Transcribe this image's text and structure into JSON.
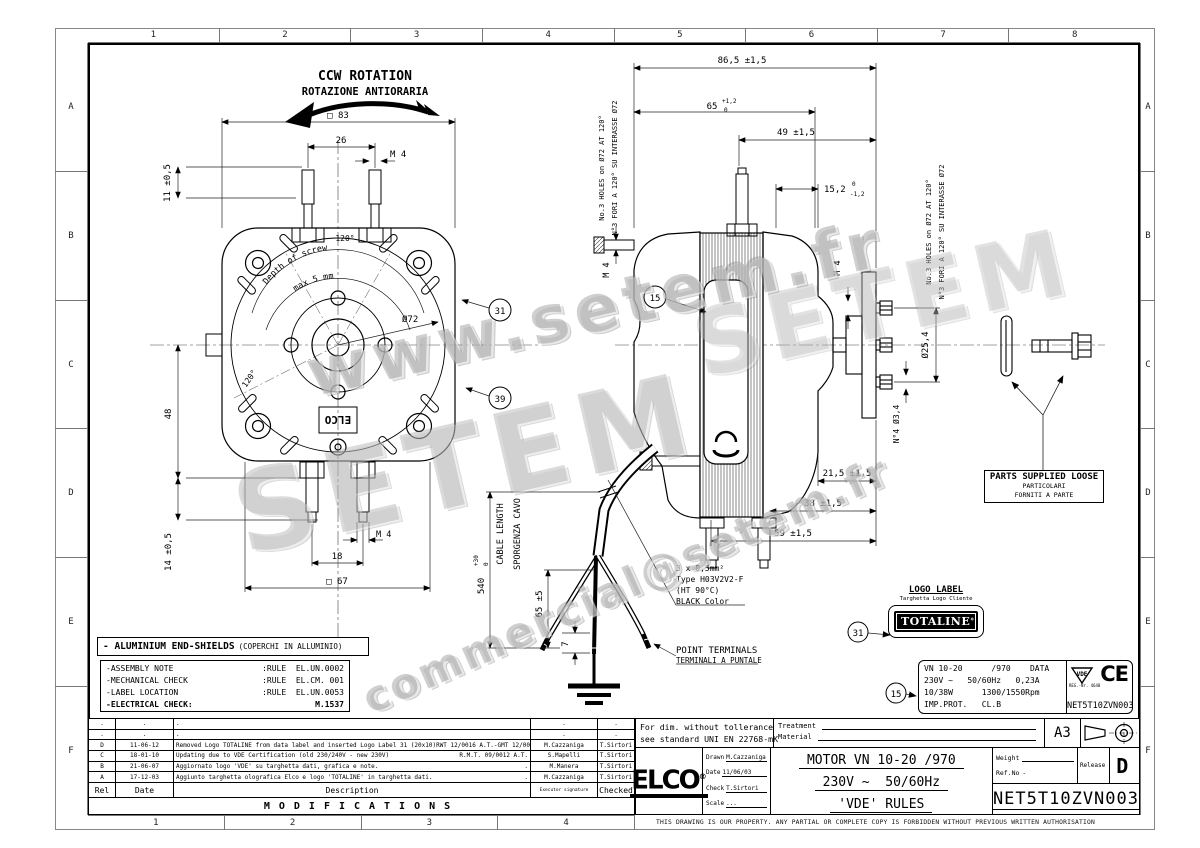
{
  "border": {
    "top": [
      "1",
      "2",
      "3",
      "4",
      "5",
      "6",
      "7",
      "8"
    ],
    "bottom": [
      "1",
      "2",
      "3",
      "4"
    ],
    "left": [
      "A",
      "B",
      "C",
      "D",
      "E",
      "F"
    ],
    "right": [
      "A",
      "B",
      "C",
      "D",
      "E",
      "F"
    ]
  },
  "watermarks": {
    "w1": "www.setem.fr",
    "w2": "SETEM",
    "w3": "commercial@setem.fr"
  },
  "rotation": {
    "en": "CCW ROTATION",
    "it": "ROTAZIONE ANTIORARIA"
  },
  "front": {
    "sq83": "□ 83",
    "d26": "26",
    "m4_top": "M 4",
    "d11": "11 ±0,5",
    "deg120_top": "120°",
    "deg120_left": "120°",
    "dia72": "Ø72",
    "depth_line1": "Depth of screw",
    "depth_line2": "max 5 mm",
    "d48": "48",
    "d14": "14 ±0,5",
    "d18": "18",
    "m4_bottom": "M 4",
    "sq67": "□ 67",
    "elco_emboss": "ELCO"
  },
  "side": {
    "d86": "86,5 ±1,5",
    "d65": "65",
    "d65_tol_top": "+1,2",
    "d65_tol_bot": "0",
    "d49": "49 ±1,5",
    "d152": "15,2",
    "d152_tol_top": "0",
    "d152_tol_bot": "-1,2",
    "m4_left": "M 4",
    "m4_right": "M 4",
    "dia254": "Ø25,4",
    "n4dia": "N°4 Ø3,4",
    "d215": "21,5 ±1,5",
    "d38": "38 ±1,5",
    "d59": "59 ±1,5",
    "holes_en": "No.3 HOLES on Ø72 AT 120°",
    "holes_it": "N°3 FORI A 120° SU INTERASSE Ø72"
  },
  "cable": {
    "len_en": "CABLE LENGTH",
    "len_it": "SPORGENZA CAVO",
    "d540": "540",
    "d540_tol_top": "+30",
    "d540_tol_bot": "0",
    "d65": "65 ±5",
    "d7": "7",
    "spec1": "3 x 0,5mm²",
    "spec2": "Type H03V2V2-F",
    "spec3": "(HT 90°C)",
    "spec4": "BLACK Color",
    "term_en": "POINT TERMINALS",
    "term_it": "TERMINALI A PUNTALE"
  },
  "callouts": {
    "c15": "15",
    "c31": "31",
    "c39": "39"
  },
  "parts_loose": {
    "en": "PARTS SUPPLIED LOOSE",
    "it1": "PARTICOLARI",
    "it2": "FORNITI A PARTE"
  },
  "logo_label": {
    "title": "LOGO LABEL",
    "subtitle": "Targhetta Logo Cliente",
    "brand": "TOTALINE"
  },
  "data_label": {
    "l1": "VN 10-20      /970    DATA",
    "l2": "230V ~   50/60Hz   0,23A",
    "l3": "10/38W      1300/1550Rpm",
    "l4": "IMP.PROT.   CL.B",
    "vde": "VDE",
    "reg": "REG.-Nr. 4648",
    "ce": "CE",
    "code": "NET5T10ZVN003"
  },
  "notes": {
    "title": "- ALUMINIUM END-SHIELDS",
    "title_it": "(COPERCHI IN ALLUMINIO)",
    "rows": [
      {
        "label": "-ASSEMBLY NOTE",
        "value": ":RULE  EL.UN.0002"
      },
      {
        "label": "-MECHANICAL CHECK",
        "value": ":RULE  EL.CM. 001"
      },
      {
        "label": "-LABEL LOCATION",
        "value": ":RULE  EL.UN.0053"
      },
      {
        "label": "-ELECTRICAL CHECK:",
        "value": "M.1537"
      }
    ]
  },
  "modifications": {
    "title": "MODIFICATIONS",
    "headers": {
      "rel": "Rel",
      "date": "Date",
      "desc": "Description",
      "exec": "Executor signature",
      "checked": "Checked"
    },
    "rows": [
      {
        "rel": ".",
        "date": ".",
        "desc": ".",
        "desc_right": "",
        "exec": ".",
        "checked": "."
      },
      {
        "rel": ".",
        "date": ".",
        "desc": ".",
        "desc_right": "",
        "exec": ".",
        "checked": "."
      },
      {
        "rel": "D",
        "date": "11-06-12",
        "desc": "Removed Logo TOTALINE from data label and inserted Logo Label 31 (20x10)RWT 12/0016 A.T.-GMT 12/0098",
        "desc_right": "",
        "exec": "M.Cazzaniga",
        "checked": "T.Sirtori"
      },
      {
        "rel": "C",
        "date": "18-01-10",
        "desc": "Updating due to VDE Certification (old 230/240V - new 230V)",
        "desc_right": "R.M.T. 09/0012 A.T.",
        "exec": "S.Mapelli",
        "checked": "T.Sirtori"
      },
      {
        "rel": "B",
        "date": "21-06-07",
        "desc": "Aggiornato logo 'VDE' su targhetta dati, grafica e note.",
        "desc_right": ".",
        "exec": "M.Manera",
        "checked": "T.Sirtori"
      },
      {
        "rel": "A",
        "date": "17-12-03",
        "desc": "Aggiunto targhetta olografica Elco e logo 'TOTALINE' in targhetta dati.",
        "desc_right": ".",
        "exec": "M.Cazzaniga",
        "checked": "T.Sirtori"
      }
    ]
  },
  "title_block": {
    "tol1": "For dim. without tollerance",
    "tol2": "see standard UNI EN 22768-mK",
    "treatment": "Treatment",
    "material": "Material",
    "paper": "A3",
    "brand": "ELCO",
    "drawn_label": "Drawn",
    "drawn": "M.Cazzaniga",
    "date_label": "Date",
    "date": "11/06/03",
    "check_label": "Check",
    "check": "T.Sirtori",
    "scale_label": "Scale",
    "scale": "...",
    "title1": "MOTOR VN 10-20 /970",
    "title2": "230V ~  50/60Hz",
    "title3": "'VDE' RULES",
    "weight_label": "Weight",
    "refno_label": "Ref.No",
    "refno": "-",
    "release_label": "Release",
    "release": "D",
    "code": "NET5T10ZVN003",
    "disclaimer": "THIS DRAWING IS OUR PROPERTY. ANY PARTIAL OR COMPLETE COPY IS FORBIDDEN WITHOUT PREVIOUS WRITTEN AUTHORISATION"
  }
}
